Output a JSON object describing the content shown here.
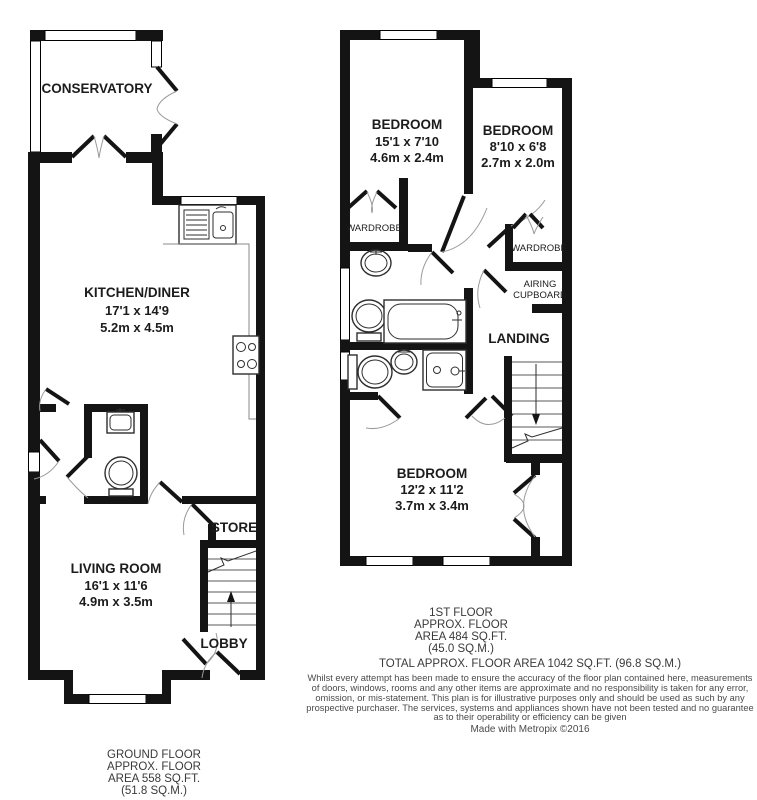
{
  "ground_floor": {
    "rooms": {
      "conservatory": {
        "name": "CONSERVATORY"
      },
      "kitchen": {
        "name": "KITCHEN/DINER",
        "imperial": "17'1 x 14'9",
        "metric": "5.2m x 4.5m"
      },
      "living": {
        "name": "LIVING ROOM",
        "imperial": "16'1 x 11'6",
        "metric": "4.9m x 3.5m"
      },
      "store": {
        "name": "STORE"
      },
      "lobby": {
        "name": "LOBBY"
      }
    },
    "caption": [
      "GROUND FLOOR",
      "APPROX. FLOOR",
      "AREA 558 SQ.FT.",
      "(51.8 SQ.M.)"
    ]
  },
  "first_floor": {
    "rooms": {
      "bedroom1": {
        "name": "BEDROOM",
        "imperial": "15'1 x 7'10",
        "metric": "4.6m x 2.4m"
      },
      "bedroom2": {
        "name": "BEDROOM",
        "imperial": "8'10 x 6'8",
        "metric": "2.7m x 2.0m"
      },
      "bedroom3": {
        "name": "BEDROOM",
        "imperial": "12'2 x 11'2",
        "metric": "3.7m x 3.4m"
      },
      "wardrobe1": {
        "name": "WARDROBE"
      },
      "wardrobe2": {
        "name": "WARDROBE"
      },
      "airing_cupboard": {
        "name_line1": "AIRING",
        "name_line2": "CUPBOARD"
      },
      "landing": {
        "name": "LANDING"
      }
    },
    "caption": [
      "1ST FLOOR",
      "APPROX. FLOOR",
      "AREA 484 SQ.FT.",
      "(45.0 SQ.M.)"
    ]
  },
  "footer": {
    "total": "TOTAL APPROX. FLOOR AREA 1042 SQ.FT. (96.8 SQ.M.)",
    "disclaimer": [
      "Whilst every attempt has been made to ensure the accuracy of the floor plan contained here, measurements",
      "of doors, windows, rooms and any other items are approximate and no responsibility is taken for any error,",
      "omission, or mis-statement. This plan is for illustrative purposes only and should be used as such by any",
      "prospective purchaser. The services, systems and appliances shown have not been tested and no guarantee",
      "as to their operability or efficiency can be given"
    ],
    "credit": "Made with Metropix ©2016"
  },
  "colors": {
    "wall": "#141414",
    "room_text": "#1c1c1c",
    "caption_text": "#3a3a3a",
    "door_arc": "#9a9a9a",
    "fixture": "#2e2e2e",
    "background": "#ffffff"
  }
}
